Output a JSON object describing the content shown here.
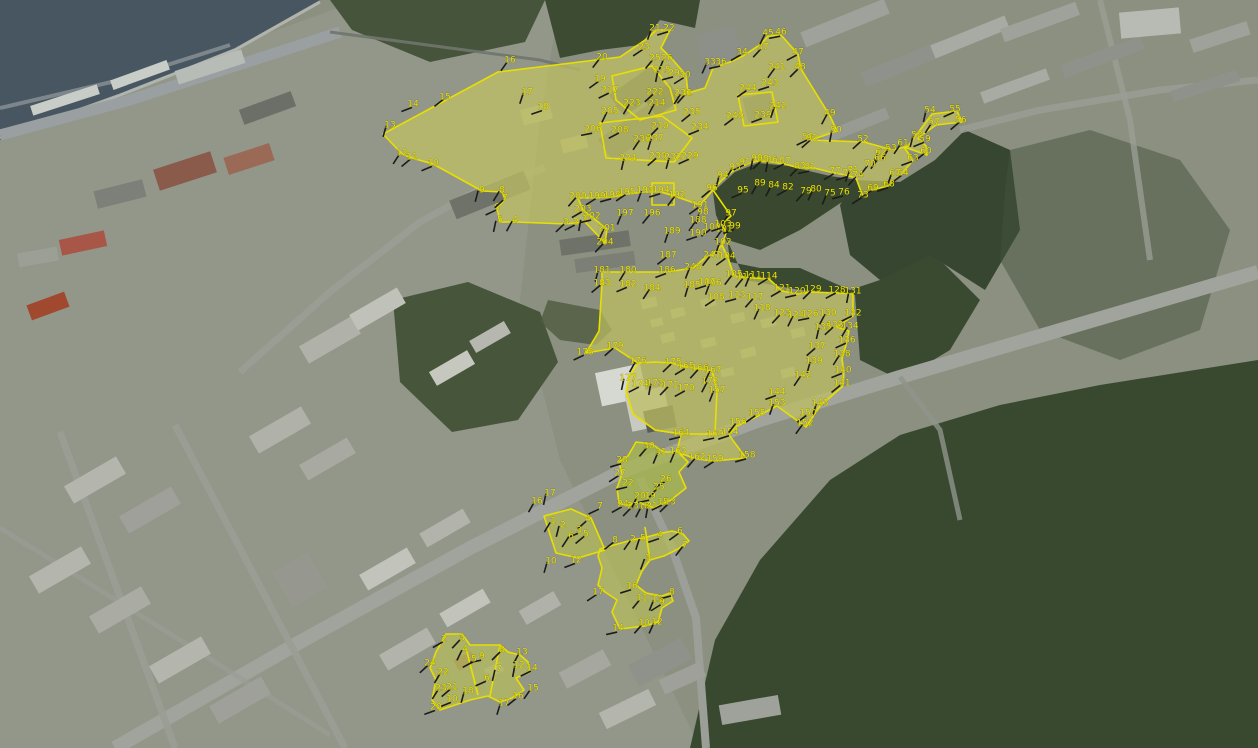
{
  "map": {
    "aria_label": "Satellite aerial map with yellow cadastral parcel boundaries and numbered survey vertices",
    "colors": {
      "boundary": "#e8df00",
      "label": "#ece405",
      "tick": "#1c1c1c",
      "parcel_fill": "rgba(222,218,70,0.30)",
      "water": "#475661",
      "forest": "#3a4a30",
      "road": "#a0a49d",
      "urban": "#9a9c92"
    },
    "polygons": [
      {
        "name": "north-parcel",
        "fill": true,
        "base": "#adb176",
        "pts": "383,134 498,72 620,57 648,38 656,30 670,30 661,48 673,60 686,75 688,93 705,88 713,68 730,62 743,56 761,44 768,36 781,35 798,54 801,69 830,116 837,131 811,140 864,142 893,150 908,146 932,114 957,111 962,122 936,125 918,138 926,146 927,155 904,147 913,160 901,175 888,186 872,190 863,197 856,178 845,175 830,172 814,168 799,168 785,164 771,162 757,161 745,165 733,171 722,180 713,190 700,205 677,197 661,192 645,192 627,194 612,197 597,198 578,198 583,210 592,217 607,229 605,243 585,222 566,224 515,222 500,222 497,208 505,199 502,192 482,191 433,164 412,158 402,154"
      },
      {
        "name": "neck-boundary",
        "fill": false,
        "open": true,
        "pts": "713,190 722,203 731,216 722,224 726,233 722,245 728,258 734,276"
      },
      {
        "name": "middle-parcel",
        "fill": true,
        "base": "#a9ad74",
        "pts": "602,272 628,272 667,272 693,268 706,257 712,255 722,245 728,258 734,276 753,278 769,279 782,291 797,294 813,292 837,293 853,294 853,316 837,327 849,331 846,345 842,359 844,372 843,386 820,406 806,427 777,406 756,417 737,426 729,435 746,458 714,461 696,459 677,452 681,434 655,430 633,414 626,392 629,377 638,363 615,348 586,353 599,331 602,284"
      },
      {
        "name": "inner-block-boundary",
        "fill": false,
        "pts": "629,377 638,363 655,362 672,363 686,367 700,369 712,371 717,390 715,434 681,434 655,430 633,414 626,392"
      },
      {
        "name": "building-outline-1",
        "fill": false,
        "pts": "612,76 652,66 670,88 676,110 640,120 616,100"
      },
      {
        "name": "building-outline-2",
        "fill": false,
        "pts": "600,123 662,116 692,138 674,162 606,158"
      },
      {
        "name": "building-outline-3",
        "fill": false,
        "pts": "738,95 772,92 778,122 744,126"
      },
      {
        "name": "building-outline-4",
        "fill": false,
        "pts": "652,183 674,183 674,205 652,205"
      },
      {
        "name": "crossing-parcel",
        "fill": true,
        "base": "#86a352",
        "pts": "636,442 652,444 664,452 678,452 688,462 679,472 686,488 671,500 654,508 637,502 627,506 619,503 617,488 622,474 619,462 628,456"
      },
      {
        "name": "parallelogram-parcel",
        "fill": true,
        "base": "#93a360",
        "pts": "544,516 571,509 591,518 605,550 578,558 556,553"
      },
      {
        "name": "lower-parcel",
        "fill": true,
        "base": "#9aa86b",
        "pts": "600,549 614,545 632,540 643,538 658,534 672,531 683,534 689,541 678,549 664,556 650,560 642,571 636,585 646,593 662,596 670,593 673,601 662,608 658,622 645,626 620,629 612,612 617,600 605,592 598,585 602,568 598,556"
      },
      {
        "name": "bottomleft-parcel",
        "fill": true,
        "base": "#9aa86b",
        "pts": "446,634 462,634 470,645 500,645 508,652 520,655 528,662 530,672 516,678 524,690 512,698 500,702 488,696 470,700 455,705 440,710 432,700 436,680 430,668 436,652"
      },
      {
        "name": "divider-1",
        "fill": false,
        "open": true,
        "pts": "466,648 478,695"
      },
      {
        "name": "divider-2",
        "fill": false,
        "open": true,
        "pts": "500,645 490,696"
      },
      {
        "name": "divider-3",
        "fill": false,
        "open": true,
        "pts": "645,527 650,560"
      }
    ],
    "markers": [
      [
        "1",
        585,
        219
      ],
      [
        "2",
        576,
        222
      ],
      [
        "3",
        566,
        222
      ],
      [
        "4",
        515,
        220
      ],
      [
        "5",
        500,
        220
      ],
      [
        "6",
        497,
        207
      ],
      [
        "7",
        505,
        198
      ],
      [
        "8",
        502,
        190
      ],
      [
        "9",
        482,
        190
      ],
      [
        "10",
        433,
        163
      ],
      [
        "11",
        412,
        157
      ],
      [
        "12",
        402,
        153
      ],
      [
        "13",
        390,
        125
      ],
      [
        "14",
        413,
        104
      ],
      [
        "15",
        445,
        97
      ],
      [
        "16",
        510,
        60
      ],
      [
        "17",
        527,
        92
      ],
      [
        "18",
        543,
        107
      ],
      [
        "19",
        600,
        79
      ],
      [
        "20",
        602,
        57
      ],
      [
        "21",
        655,
        28
      ],
      [
        "22",
        669,
        28
      ],
      [
        "23",
        644,
        47
      ],
      [
        "25",
        655,
        58
      ],
      [
        "26",
        667,
        58
      ],
      [
        "29",
        674,
        73
      ],
      [
        "30",
        685,
        75
      ],
      [
        "31",
        687,
        93
      ],
      [
        "33",
        710,
        62
      ],
      [
        "36",
        721,
        62
      ],
      [
        "34",
        742,
        52
      ],
      [
        "37",
        763,
        47
      ],
      [
        "45",
        768,
        33
      ],
      [
        "46",
        781,
        32
      ],
      [
        "47",
        798,
        52
      ],
      [
        "48",
        800,
        67
      ],
      [
        "49",
        830,
        113
      ],
      [
        "50",
        836,
        130
      ],
      [
        "51",
        808,
        137
      ],
      [
        "52",
        863,
        139
      ],
      [
        "53",
        891,
        148
      ],
      [
        "54",
        930,
        110
      ],
      [
        "55",
        955,
        109
      ],
      [
        "56",
        961,
        120
      ],
      [
        "57",
        934,
        122
      ],
      [
        "58",
        917,
        135
      ],
      [
        "59",
        925,
        139
      ],
      [
        "60",
        926,
        151
      ],
      [
        "61",
        903,
        143
      ],
      [
        "62",
        881,
        152
      ],
      [
        "63",
        913,
        158
      ],
      [
        "64",
        903,
        173
      ],
      [
        "66",
        880,
        158
      ],
      [
        "67",
        895,
        173
      ],
      [
        "68",
        889,
        184
      ],
      [
        "69",
        873,
        188
      ],
      [
        "70",
        870,
        164
      ],
      [
        "71",
        853,
        170
      ],
      [
        "72",
        848,
        173
      ],
      [
        "73",
        863,
        195
      ],
      [
        "74",
        858,
        175
      ],
      [
        "75",
        830,
        193
      ],
      [
        "76",
        844,
        192
      ],
      [
        "77",
        835,
        171
      ],
      [
        "79",
        806,
        191
      ],
      [
        "80",
        816,
        189
      ],
      [
        "81",
        810,
        167
      ],
      [
        "82",
        788,
        187
      ],
      [
        "83",
        800,
        166
      ],
      [
        "84",
        774,
        185
      ],
      [
        "86",
        772,
        160
      ],
      [
        "87",
        785,
        161
      ],
      [
        "88",
        763,
        159
      ],
      [
        "89",
        760,
        183
      ],
      [
        "90",
        757,
        158
      ],
      [
        "91",
        745,
        162
      ],
      [
        "92",
        812,
        138
      ],
      [
        "93",
        735,
        167
      ],
      [
        "94",
        723,
        175
      ],
      [
        "95",
        743,
        190
      ],
      [
        "96",
        712,
        188
      ],
      [
        "97",
        731,
        213
      ],
      [
        "98",
        703,
        212
      ],
      [
        "99",
        735,
        226
      ],
      [
        "100",
        712,
        227
      ],
      [
        "101",
        724,
        229
      ],
      [
        "102",
        723,
        242
      ],
      [
        "103",
        723,
        224
      ],
      [
        "104",
        727,
        256
      ],
      [
        "105",
        734,
        274
      ],
      [
        "106",
        713,
        283
      ],
      [
        "107",
        707,
        282
      ],
      [
        "108",
        716,
        297
      ],
      [
        "110",
        745,
        277
      ],
      [
        "111",
        753,
        275
      ],
      [
        "113",
        737,
        295
      ],
      [
        "114",
        769,
        276
      ],
      [
        "117",
        755,
        297
      ],
      [
        "118",
        762,
        308
      ],
      [
        "120",
        797,
        291
      ],
      [
        "121",
        782,
        288
      ],
      [
        "123",
        782,
        313
      ],
      [
        "124",
        796,
        315
      ],
      [
        "126",
        810,
        314
      ],
      [
        "128",
        837,
        290
      ],
      [
        "129",
        813,
        289
      ],
      [
        "130",
        828,
        313
      ],
      [
        "131",
        853,
        291
      ],
      [
        "132",
        853,
        313
      ],
      [
        "133",
        835,
        325
      ],
      [
        "134",
        850,
        326
      ],
      [
        "135",
        823,
        327
      ],
      [
        "136",
        847,
        340
      ],
      [
        "137",
        817,
        346
      ],
      [
        "138",
        842,
        354
      ],
      [
        "139",
        814,
        361
      ],
      [
        "140",
        843,
        370
      ],
      [
        "141",
        842,
        383
      ],
      [
        "142",
        803,
        375
      ],
      [
        "143",
        820,
        403
      ],
      [
        "144",
        777,
        392
      ],
      [
        "150",
        808,
        413
      ],
      [
        "152",
        805,
        423
      ],
      [
        "153",
        777,
        403
      ],
      [
        "154",
        730,
        432
      ],
      [
        "155",
        757,
        413
      ],
      [
        "156",
        738,
        422
      ],
      [
        "157",
        717,
        390
      ],
      [
        "158",
        747,
        455
      ],
      [
        "159",
        715,
        459
      ],
      [
        "162",
        697,
        457
      ],
      [
        "163",
        678,
        451
      ],
      [
        "164",
        681,
        433
      ],
      [
        "165",
        686,
        366
      ],
      [
        "166",
        700,
        368
      ],
      [
        "167",
        713,
        370
      ],
      [
        "169",
        715,
        434
      ],
      [
        "170",
        686,
        388
      ],
      [
        "171",
        670,
        385
      ],
      [
        "172",
        710,
        381
      ],
      [
        "173",
        655,
        383
      ],
      [
        "174",
        640,
        384
      ],
      [
        "175",
        673,
        362
      ],
      [
        "176",
        638,
        361
      ],
      [
        "177",
        628,
        378
      ],
      [
        "178",
        585,
        352
      ],
      [
        "179",
        615,
        346
      ],
      [
        "180",
        628,
        270
      ],
      [
        "181",
        602,
        270
      ],
      [
        "182",
        628,
        284
      ],
      [
        "183",
        602,
        283
      ],
      [
        "184",
        652,
        288
      ],
      [
        "185",
        692,
        285
      ],
      [
        "186",
        667,
        270
      ],
      [
        "187",
        668,
        255
      ],
      [
        "188",
        698,
        220
      ],
      [
        "189",
        672,
        231
      ],
      [
        "190",
        698,
        233
      ],
      [
        "191",
        700,
        205
      ],
      [
        "192",
        677,
        195
      ],
      [
        "193",
        645,
        190
      ],
      [
        "194",
        661,
        190
      ],
      [
        "195",
        627,
        192
      ],
      [
        "196",
        652,
        213
      ],
      [
        "197",
        625,
        213
      ],
      [
        "198",
        612,
        195
      ],
      [
        "199",
        597,
        196
      ],
      [
        "200",
        578,
        196
      ],
      [
        "201",
        607,
        228
      ],
      [
        "202",
        592,
        216
      ],
      [
        "203",
        583,
        209
      ],
      [
        "204",
        605,
        242
      ],
      [
        "205",
        610,
        111
      ],
      [
        "206",
        593,
        129
      ],
      [
        "208",
        620,
        130
      ],
      [
        "210",
        660,
        126
      ],
      [
        "214",
        657,
        103
      ],
      [
        "215",
        662,
        70
      ],
      [
        "217",
        610,
        90
      ],
      [
        "222",
        655,
        92
      ],
      [
        "223",
        632,
        103
      ],
      [
        "224",
        628,
        158
      ],
      [
        "229",
        690,
        156
      ],
      [
        "230",
        658,
        156
      ],
      [
        "231",
        683,
        93
      ],
      [
        "232",
        673,
        157
      ],
      [
        "234",
        700,
        127
      ],
      [
        "235",
        692,
        112
      ],
      [
        "236",
        642,
        139
      ],
      [
        "237",
        655,
        138
      ],
      [
        "239",
        763,
        115
      ],
      [
        "240",
        735,
        116
      ],
      [
        "241",
        777,
        67
      ],
      [
        "242",
        778,
        106
      ],
      [
        "243",
        770,
        83
      ],
      [
        "244",
        748,
        88
      ],
      [
        "247",
        712,
        255
      ],
      [
        "248",
        693,
        267
      ],
      [
        "28",
        622,
        460
      ],
      [
        "27",
        620,
        473
      ],
      [
        "30",
        649,
        446
      ],
      [
        "31",
        661,
        452
      ],
      [
        "22",
        628,
        483
      ],
      [
        "26",
        666,
        479
      ],
      [
        "25",
        659,
        487
      ],
      [
        "20",
        640,
        496
      ],
      [
        "19",
        650,
        496
      ],
      [
        "24",
        623,
        504
      ],
      [
        "23",
        633,
        506
      ],
      [
        "18",
        644,
        506
      ],
      [
        "21",
        652,
        506
      ],
      [
        "15",
        663,
        502
      ],
      [
        "13",
        670,
        502
      ],
      [
        "16",
        537,
        501
      ],
      [
        "17",
        550,
        493
      ],
      [
        "7",
        600,
        506
      ],
      [
        "4",
        588,
        519
      ],
      [
        "1",
        553,
        521
      ],
      [
        "2",
        563,
        525
      ],
      [
        "3",
        579,
        530
      ],
      [
        "5",
        586,
        534
      ],
      [
        "6",
        571,
        536
      ],
      [
        "10",
        551,
        561
      ],
      [
        "12",
        576,
        560
      ],
      [
        "8",
        615,
        540
      ],
      [
        "2",
        633,
        539
      ],
      [
        "5",
        643,
        538
      ],
      [
        "4",
        660,
        535
      ],
      [
        "6",
        680,
        531
      ],
      [
        "7",
        685,
        545
      ],
      [
        "3",
        648,
        558
      ],
      [
        "16",
        632,
        586
      ],
      [
        "17",
        598,
        592
      ],
      [
        "11",
        642,
        598
      ],
      [
        "13",
        657,
        599
      ],
      [
        "8",
        672,
        592
      ],
      [
        "9",
        662,
        602
      ],
      [
        "10",
        644,
        623
      ],
      [
        "12",
        657,
        622
      ],
      [
        "14",
        618,
        628
      ],
      [
        "2",
        444,
        639
      ],
      [
        "3",
        462,
        638
      ],
      [
        "4",
        465,
        649
      ],
      [
        "9",
        482,
        656
      ],
      [
        "5",
        474,
        659
      ],
      [
        "8",
        502,
        650
      ],
      [
        "13",
        522,
        652
      ],
      [
        "12",
        519,
        665
      ],
      [
        "14",
        532,
        668
      ],
      [
        "24",
        430,
        663
      ],
      [
        "22",
        443,
        672
      ],
      [
        "7",
        499,
        669
      ],
      [
        "6",
        487,
        678
      ],
      [
        "21",
        452,
        687
      ],
      [
        "23",
        441,
        688
      ],
      [
        "18",
        468,
        691
      ],
      [
        "10",
        452,
        699
      ],
      [
        "16",
        518,
        696
      ],
      [
        "15",
        533,
        688
      ],
      [
        "17",
        504,
        703
      ],
      [
        "20",
        436,
        707
      ]
    ]
  }
}
